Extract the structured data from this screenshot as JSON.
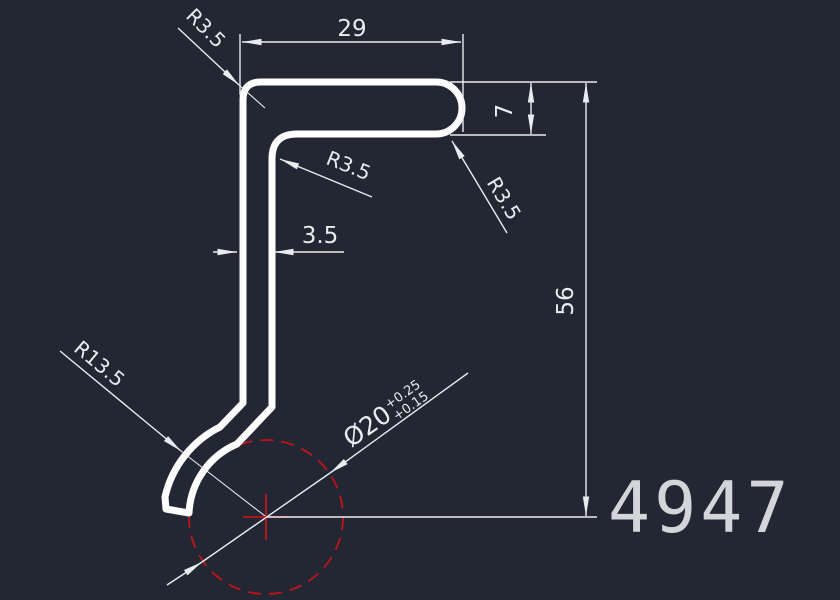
{
  "drawing": {
    "background": "#222733",
    "line_color": "#e9ecef",
    "profile_color": "#ffffff",
    "reference_red": "#c01418",
    "part_number": "4947",
    "part_number_color": "#d3d6d9",
    "dims": {
      "top_width": "29",
      "flange_height": "7",
      "overall_height": "56",
      "wall_thickness": "3.5",
      "radius_top_left": "R3.5",
      "radius_inner_corner": "R3.5",
      "radius_flange_end": "R3.5",
      "radius_hook": "R13.5",
      "bore_diameter": "Ø20",
      "bore_tol_upper": "+0.25",
      "bore_tol_lower": "+0.15"
    }
  }
}
